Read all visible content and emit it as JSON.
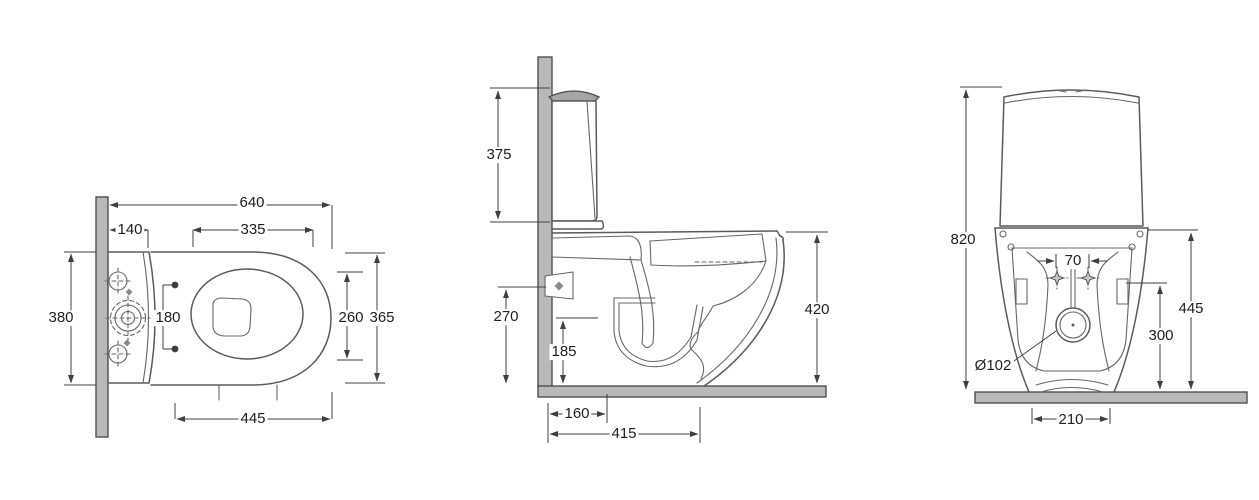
{
  "colors": {
    "background": "#ffffff",
    "line": "#5b5b5b",
    "dimension_line": "#3f3f3f",
    "wall_fill": "#b9b9b9",
    "text": "#1f1f1f"
  },
  "views": {
    "top": {
      "dims": {
        "overall_length": "640",
        "cistern_top_depth": "140",
        "seat_opening_length": "335",
        "overall_width": "380",
        "fixing_hole_spacing": "180",
        "bowl_inner_width": "260",
        "seat_outer_width": "365",
        "pan_projection": "445"
      }
    },
    "side": {
      "dims": {
        "cistern_height": "375",
        "water_inlet_height": "270",
        "trap_outlet_height": "185",
        "rim_height": "420",
        "outlet_setout": "160",
        "base_depth": "415"
      }
    },
    "rear": {
      "dims": {
        "overall_height": "820",
        "fixing_spacing": "70",
        "rear_rim_height": "445",
        "side_panel_height": "300",
        "outlet_diameter": "Ø102",
        "base_width": "210"
      }
    }
  }
}
